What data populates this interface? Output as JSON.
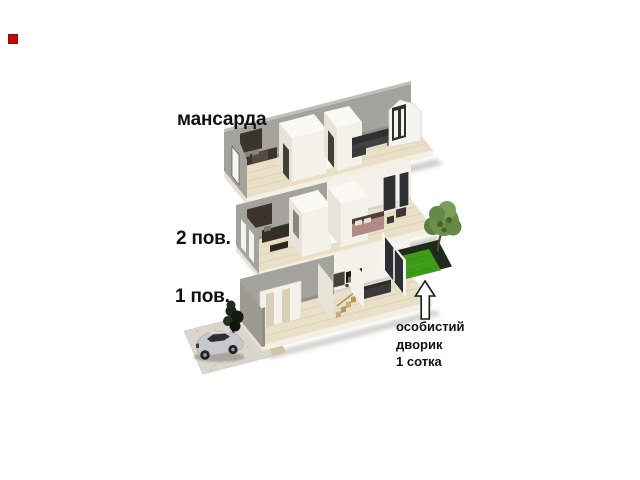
{
  "marker": {
    "color": "#c40b0b"
  },
  "labels": {
    "attic": "мансарда",
    "floor2": "2 пов.",
    "floor1": "1 пов."
  },
  "annotation": {
    "line1": "особистий",
    "line2": "дворик",
    "line3": "1 сотка"
  },
  "colors": {
    "background": "#ffffff",
    "text": "#111111",
    "marker": "#c40b0b",
    "wood": "#e9dec6",
    "woodLine": "#d6c9ae",
    "slab": "#f3efe5",
    "slabSide": "#e6e1d3",
    "wallGray": "#a3a29c",
    "wallGrayDark": "#8f8d86",
    "wallWhite": "#f4f1ea",
    "wallWhiteShade": "#e7e3d8",
    "opening": "#453e34",
    "furnitureDark": "#3a3a3a",
    "bedDark": "#3b352c",
    "bedMauve": "#b08a84",
    "grass": "#3e9b1a",
    "hedge": "#222a1d",
    "treeFoliage": "#6e9149",
    "trunk": "#54462f",
    "glass": "#2c3033",
    "frameWhite": "#f6f4ee",
    "carBody": "#c7c8cb",
    "carGlass": "#2c2e31",
    "driveway": "#dad6cd",
    "band": "#cfc4a9",
    "shadow": "#8e8a82"
  }
}
